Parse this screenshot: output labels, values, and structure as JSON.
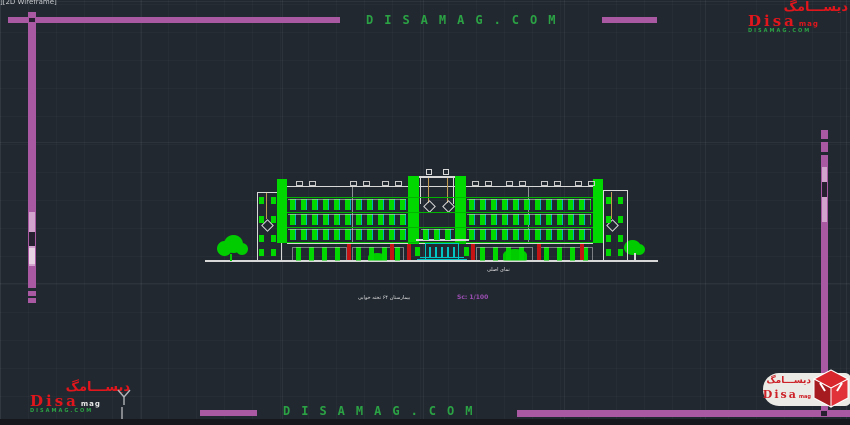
{
  "viewport": {
    "label": "][2D Wireframe]"
  },
  "watermark": {
    "text_top": "DISAMAG.COM",
    "text_bottom": "DISAMAG.COM",
    "color": "#2ba244"
  },
  "logo": {
    "persian": "ديســـامگ",
    "brand": "Disa",
    "brand_suffix": "mag",
    "site": "DISAMAG.COM"
  },
  "drawing": {
    "title": "نمای اصلی",
    "caption": "بیمارستان ۶۴ تخته خوابی",
    "scale": "Sc: 1/100"
  },
  "colors": {
    "background": "#212830",
    "frame_magenta": "#a959a1",
    "cad_green": "#00d800",
    "cad_cyan": "#00c6c6",
    "cad_red": "#c41414",
    "cad_white": "#d8d8d8",
    "cable_tan": "#c09a50",
    "logo_red": "#e0161c",
    "watermark_green": "#2ba244"
  }
}
